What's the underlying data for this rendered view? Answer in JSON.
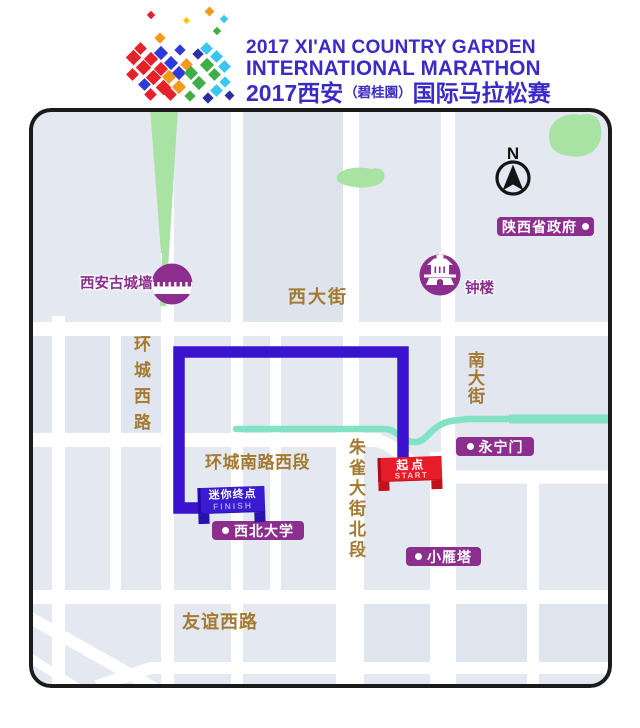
{
  "header": {
    "line1": "2017 XI'AN COUNTRY GARDEN",
    "line2": "INTERNATIONAL MARATHON",
    "line3_main": "2017西安",
    "line3_paren": "（碧桂園）",
    "line3_tail": "国际马拉松赛"
  },
  "map": {
    "compass": "N",
    "badges": {
      "shaanxi_gov": "陕西省政府",
      "yongningmen": "永宁门",
      "northwest_university": "西北大学",
      "xiaoyanta": "小雁塔"
    },
    "pois": {
      "city_wall": "西安古城墙",
      "bell_tower": "钟楼"
    },
    "streets": {
      "xidajie": "西大街",
      "huancheng_xilu": "环城西路",
      "nandajie": "南大街",
      "huancheng_nanlu_xiduan": "环城南路西段",
      "zhuque_dajie_beiduan": "朱雀大街北段",
      "youyi_xilu": "友谊西路"
    },
    "markers": {
      "start": {
        "label": "起点",
        "sub": "START"
      },
      "finish": {
        "label": "迷你终点",
        "sub": "FINISH"
      }
    },
    "colors": {
      "badge_purple": "#8C2E8E",
      "route_blue": "#3A13CE",
      "start_red": "#E81C28",
      "finish_blue": "#3A1BD0",
      "moat_teal": "#82E2C5",
      "park_green": "#A9E3A3",
      "street_label_brown": "#A5792F",
      "header_blue": "#3A2BC8",
      "map_background": "#E4E9F1"
    }
  }
}
